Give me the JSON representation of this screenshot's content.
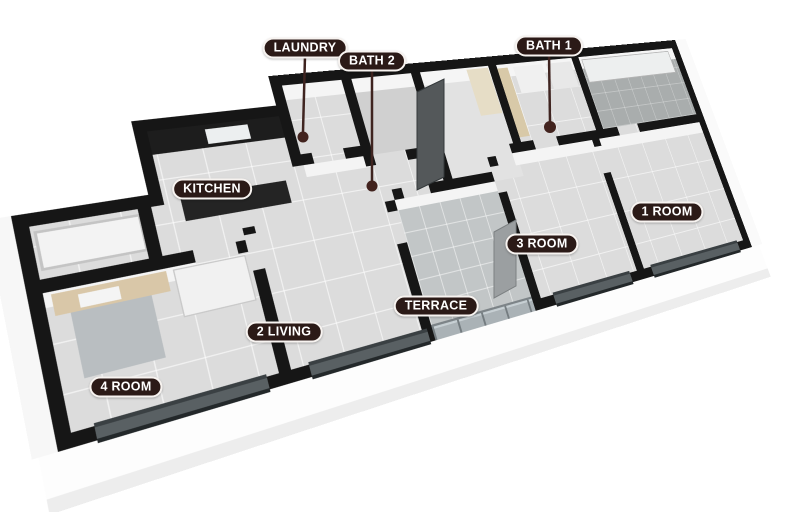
{
  "scene": {
    "type": "3d-floorplan-render",
    "background": "#ffffff"
  },
  "labels": {
    "laundry": {
      "text": "LAUNDRY",
      "has_leader_line": true
    },
    "bath2": {
      "text": "BATH 2",
      "has_leader_line": true
    },
    "bath1": {
      "text": "BATH 1",
      "has_leader_line": true
    },
    "kitchen": {
      "text": "KITCHEN",
      "has_leader_line": false
    },
    "room1": {
      "text": "1 ROOM",
      "has_leader_line": false
    },
    "room3": {
      "text": "3 ROOM",
      "has_leader_line": false
    },
    "terrace": {
      "text": "TERRACE",
      "has_leader_line": false
    },
    "living": {
      "text": "2 LIVING",
      "has_leader_line": false
    },
    "room4": {
      "text": "4 ROOM",
      "has_leader_line": false
    }
  },
  "colors": {
    "label_bg": "#2b1a17",
    "label_text": "#ffffff",
    "label_border": "#f7f3f0",
    "leader_line": "#3f2420",
    "wall_top": "#161616",
    "floor_tile": "#dcdcdc",
    "terrace_floor": "#c2c6c7",
    "dark_bath_floor": "#a9adad",
    "kitchen_counter": "#1d1d1d",
    "wood_furniture": "#d9c7a8",
    "exterior_face": "#fdfdfd"
  }
}
